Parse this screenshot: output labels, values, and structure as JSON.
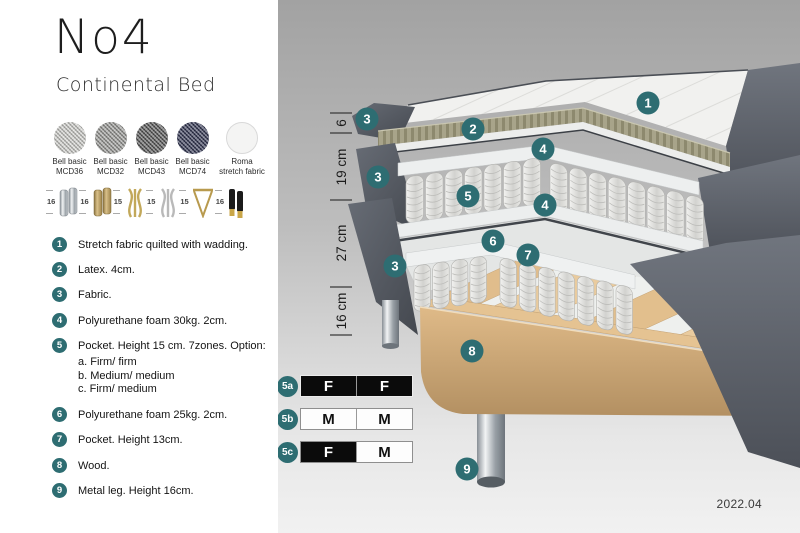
{
  "header": {
    "title": "No4",
    "subtitle": "Continental Bed"
  },
  "fabric_swatches": [
    {
      "name": "Bell basic",
      "code": "MCD36",
      "color": "#d6d6d2"
    },
    {
      "name": "Bell basic",
      "code": "MCD32",
      "color": "#9e9e9b"
    },
    {
      "name": "Bell basic",
      "code": "MCD43",
      "color": "#585858"
    },
    {
      "name": "Bell basic",
      "code": "MCD74",
      "color": "#2f3352"
    },
    {
      "name": "Roma",
      "code": "stretch fabric",
      "color": "#f4f4f3"
    }
  ],
  "leg_options": [
    {
      "height": "16",
      "style": "chrome cylinder"
    },
    {
      "height": "16",
      "style": "brass cylinder"
    },
    {
      "height": "15",
      "style": "gold curved"
    },
    {
      "height": "15",
      "style": "silver curved"
    },
    {
      "height": "15",
      "style": "gold hairpin"
    },
    {
      "height": "16",
      "style": "black with brass foot"
    }
  ],
  "parts": [
    {
      "num": "1",
      "text": "Stretch fabric quilted with wadding."
    },
    {
      "num": "2",
      "text": "Latex. 4cm."
    },
    {
      "num": "3",
      "text": "Fabric."
    },
    {
      "num": "4",
      "text": "Polyurethane foam 30kg. 2cm."
    },
    {
      "num": "5",
      "text": "Pocket. Height 15 cm. 7zones. Option:",
      "options": [
        "a. Firm/ firm",
        "b. Medium/ medium",
        "c. Firm/ medium"
      ]
    },
    {
      "num": "6",
      "text": "Polyurethane foam 25kg. 2cm."
    },
    {
      "num": "7",
      "text": "Pocket. Height 13cm."
    },
    {
      "num": "8",
      "text": "Wood."
    },
    {
      "num": "9",
      "text": "Metal leg. Height 16cm."
    }
  ],
  "illustration": {
    "callouts": [
      "1",
      "2",
      "3",
      "3",
      "3",
      "4",
      "4",
      "5",
      "6",
      "7",
      "8",
      "9"
    ],
    "dimensions": [
      "6",
      "19 cm",
      "27 cm",
      "16 cm"
    ]
  },
  "firmness_options": [
    {
      "label": "5a",
      "cells": [
        {
          "letter": "F",
          "tone": "dark"
        },
        {
          "letter": "F",
          "tone": "dark"
        }
      ]
    },
    {
      "label": "5b",
      "cells": [
        {
          "letter": "M",
          "tone": "light"
        },
        {
          "letter": "M",
          "tone": "light"
        }
      ]
    },
    {
      "label": "5c",
      "cells": [
        {
          "letter": "F",
          "tone": "dark"
        },
        {
          "letter": "M",
          "tone": "light"
        }
      ]
    }
  ],
  "version": "2022.04",
  "colors": {
    "accent": "#2e6d72"
  }
}
